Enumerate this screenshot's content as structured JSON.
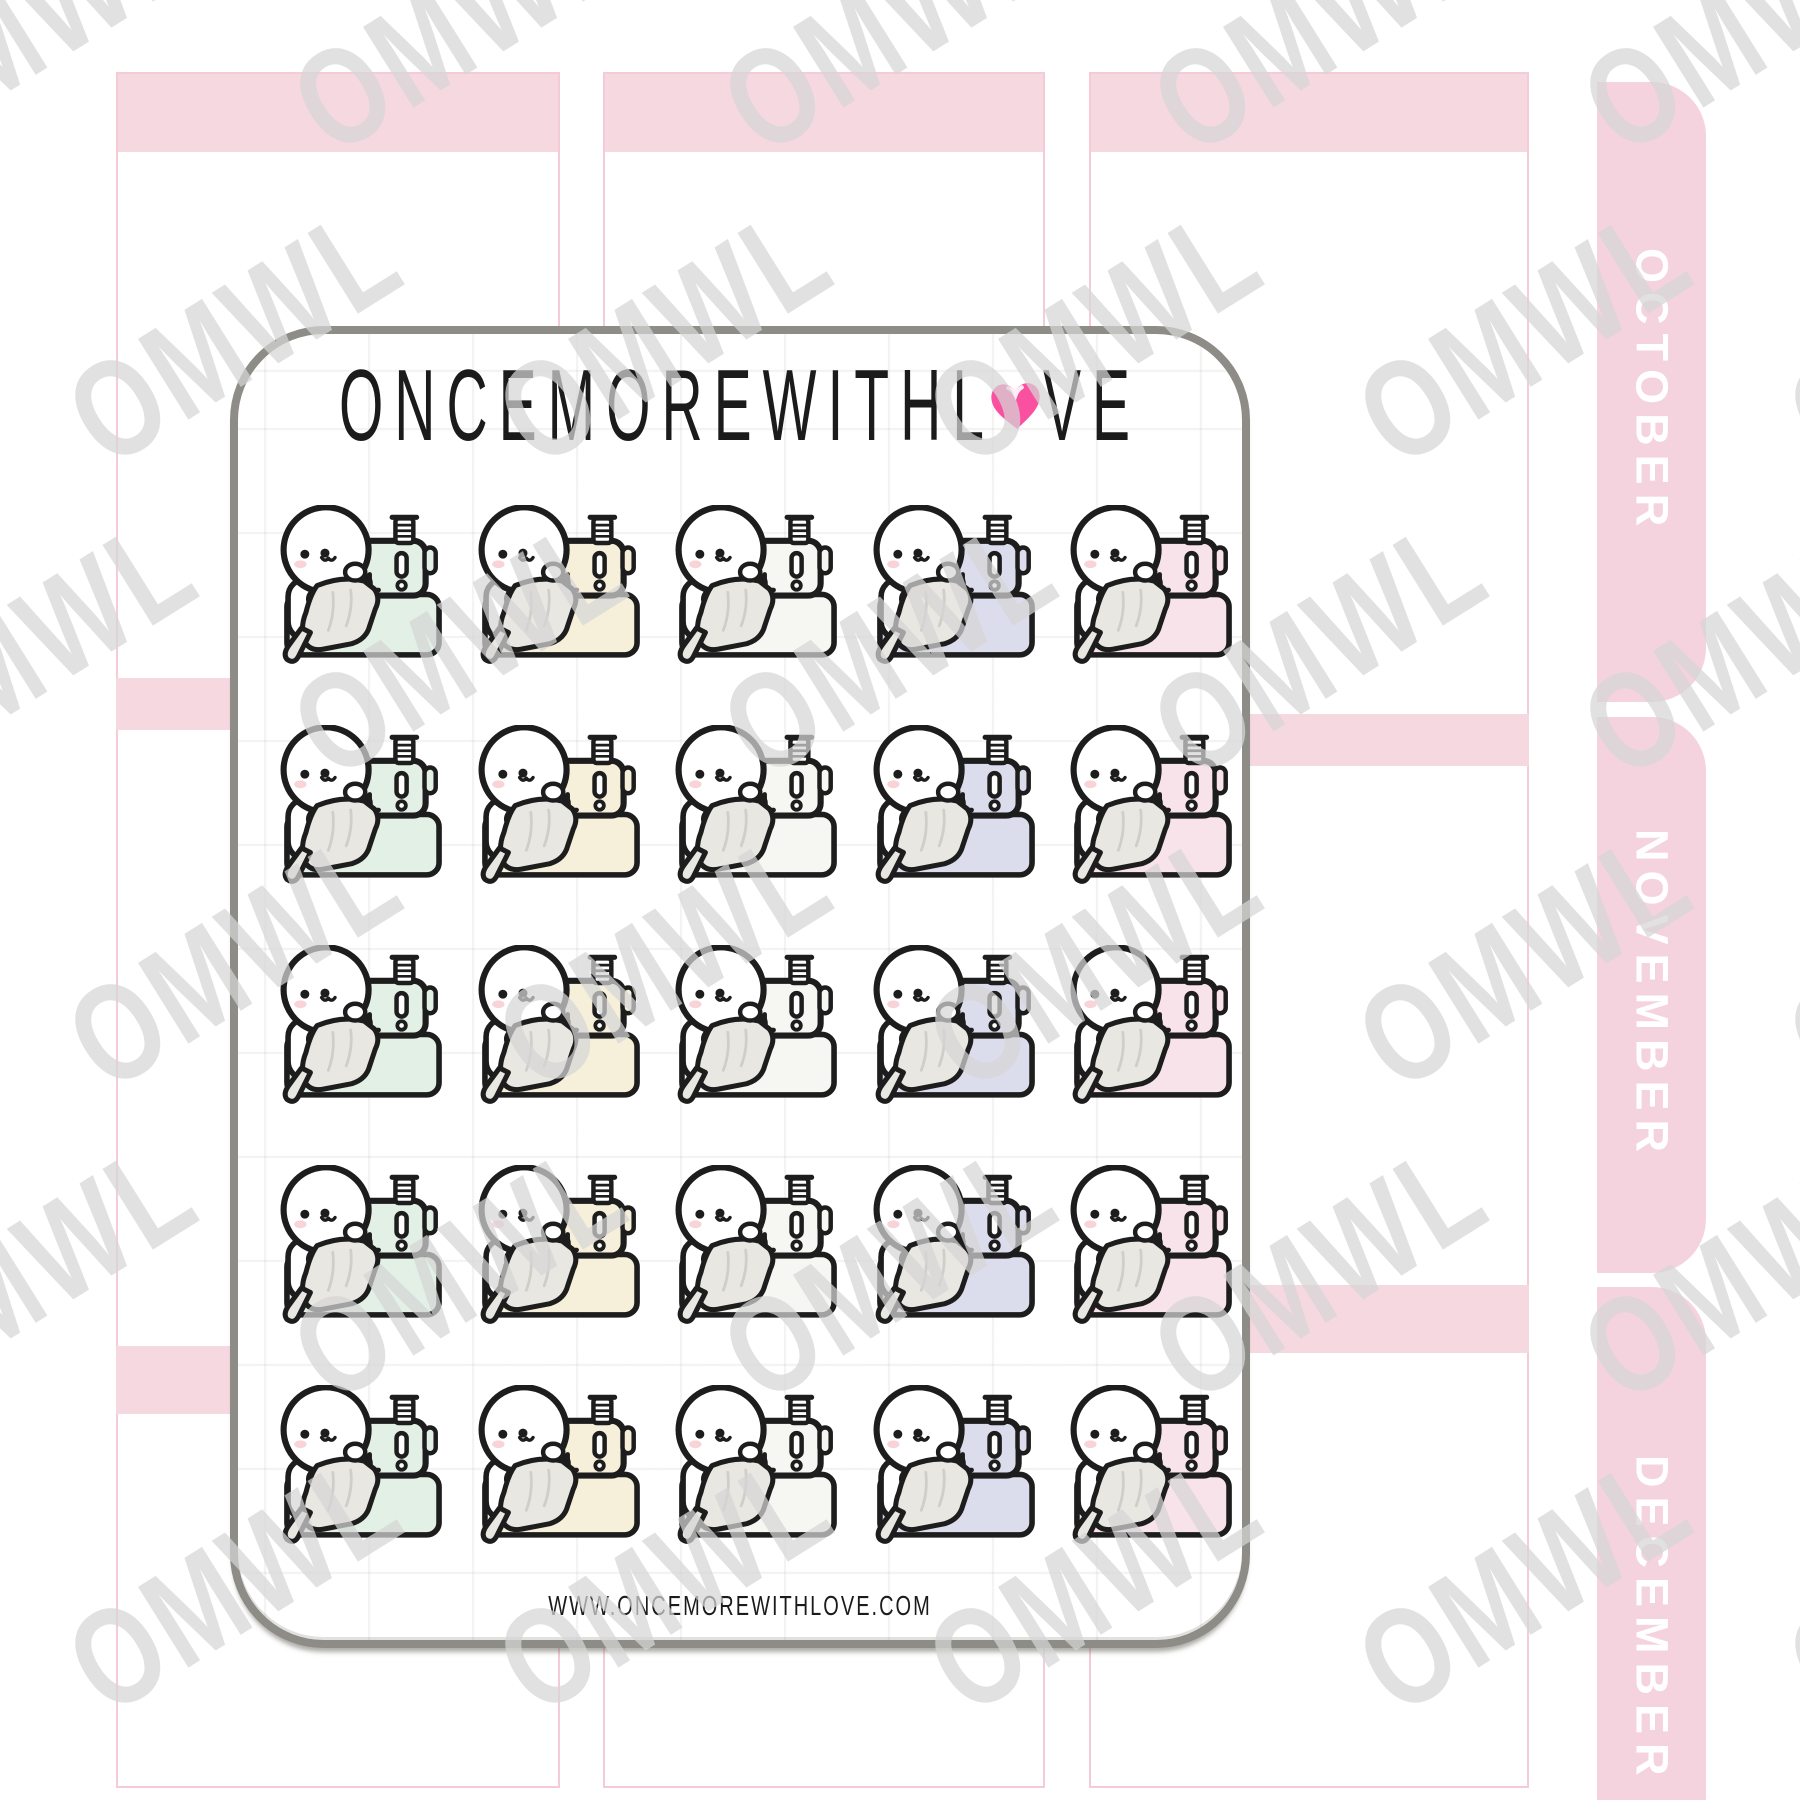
{
  "planner": {
    "header_color": "#f6d8e0",
    "tab_color": "#f5d3de",
    "border_color": "#f5cbd7",
    "tab_text_color": "#ffffff",
    "tabs": [
      {
        "label": "OCTOBER"
      },
      {
        "label": "NOVEMBER"
      },
      {
        "label": "DECEMBER"
      }
    ]
  },
  "sheet": {
    "brand_before_heart": "ONCEMOREWITHL",
    "brand_after_heart": "VE",
    "heart_color": "#f9509f",
    "website": "WWW.ONCEMOREWITHLOVE.COM",
    "border_color": "#8d8c87"
  },
  "watermark": {
    "text": "OMWL",
    "color": "rgba(213,213,213,0.72)"
  },
  "stickers": {
    "description": "doodle character sewing at a pastel sewing machine",
    "rows": 5,
    "columns": 5,
    "outline_color": "#1d1d1d",
    "fabric_color": "#e8e7e2",
    "variants": [
      {
        "name": "mint",
        "machine_color": "#e2f0e5"
      },
      {
        "name": "cream",
        "machine_color": "#f6efd9"
      },
      {
        "name": "white",
        "machine_color": "#f6f6f3"
      },
      {
        "name": "lavender",
        "machine_color": "#dbdcec"
      },
      {
        "name": "pink",
        "machine_color": "#f9e3ea"
      }
    ]
  }
}
